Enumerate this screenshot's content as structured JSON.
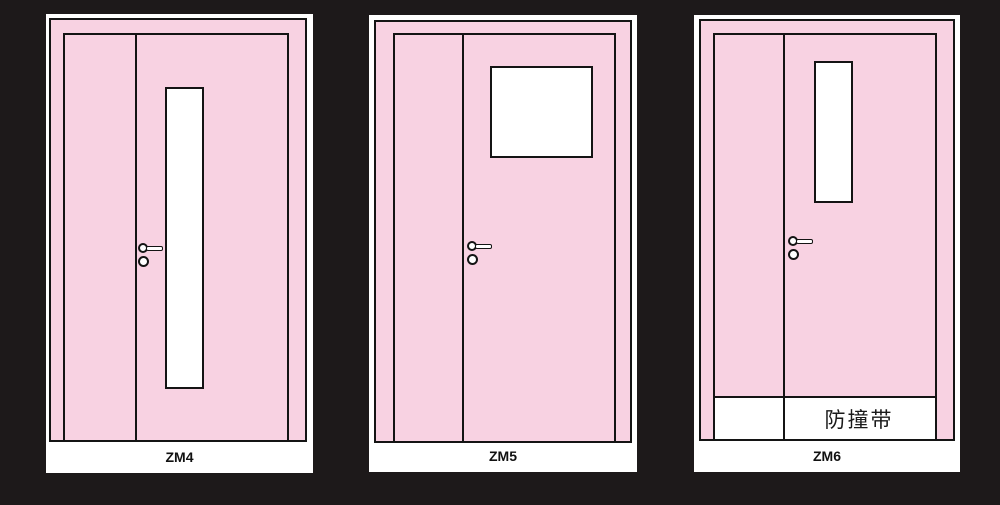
{
  "palette": {
    "bg": "#1d191a",
    "surround": "#ffffff",
    "door_fill": "#f8d2e2",
    "line": "#141414"
  },
  "doors": [
    {
      "id": "zm4",
      "label": "ZM4",
      "window_type": "tall-narrow-vision-panel",
      "band_label": ""
    },
    {
      "id": "zm5",
      "label": "ZM5",
      "window_type": "square-vision-panel",
      "band_label": ""
    },
    {
      "id": "zm6",
      "label": "ZM6",
      "window_type": "narrow-vision-panel",
      "band_label": "防撞带"
    }
  ]
}
